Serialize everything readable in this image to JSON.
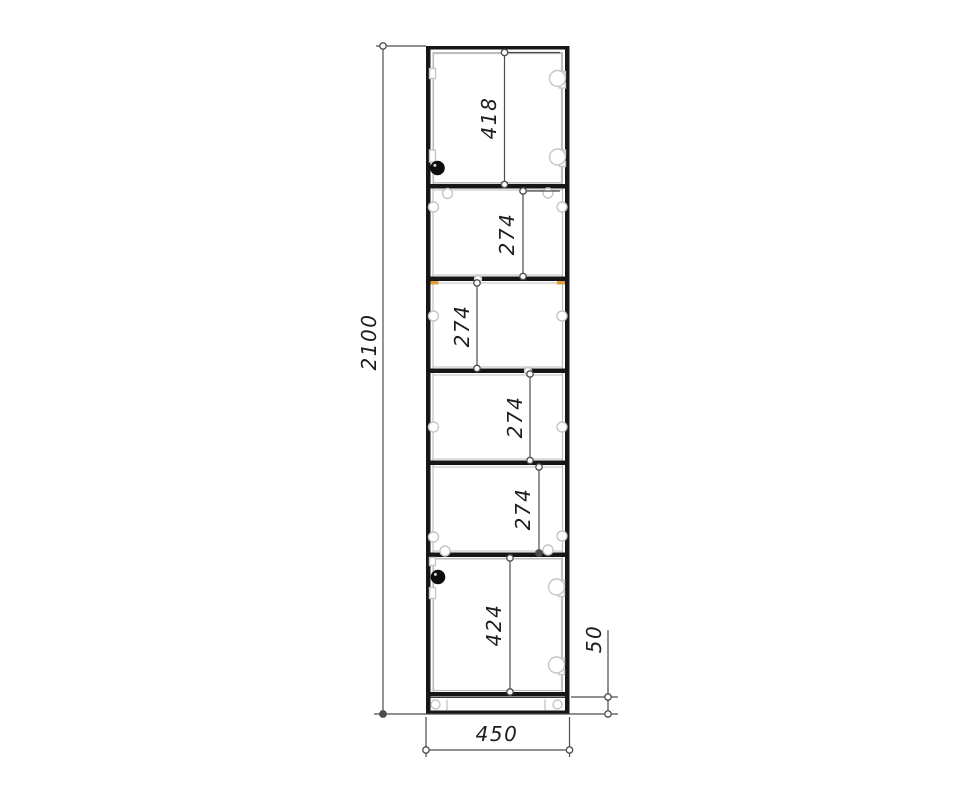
{
  "drawing": {
    "overall_height": "2100",
    "overall_width": "450",
    "plinth_height": "50",
    "section_heights": [
      "418",
      "274",
      "274",
      "274",
      "274",
      "424"
    ],
    "colors": {
      "background": "#ffffff",
      "carcass_outline": "#161616",
      "panel_edge": "#bdbdbd",
      "dimension_line": "#4d4d4d",
      "dimension_text": "#1d1d1d",
      "hardware": "#c6c6c6",
      "edge_banding": "#dc9f3c",
      "knob": "#0d0d0d"
    }
  }
}
